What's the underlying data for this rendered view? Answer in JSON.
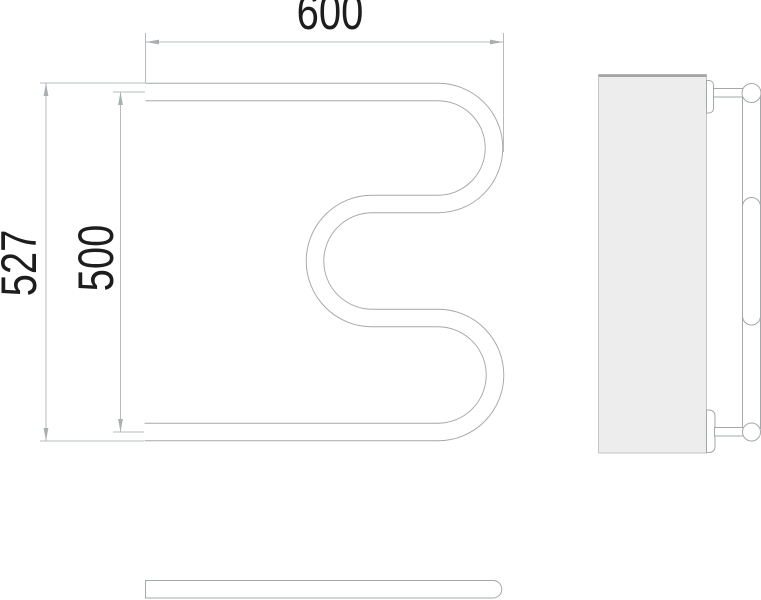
{
  "drawing": {
    "type": "towel-rail technical drawing, three orthographic views",
    "dimensions": {
      "width": "600",
      "height_overall": "527",
      "height_between_axes": "500"
    }
  },
  "colors": {
    "line": "#a3a8aa",
    "dim-line": "#b6bcbe",
    "dim-arrow": "#a9aeb0",
    "text": "#1d1d1d",
    "panel-fill": "#ededee",
    "panel-border": "#c4c4c4",
    "panel-border-top": "#a6a6a6"
  }
}
